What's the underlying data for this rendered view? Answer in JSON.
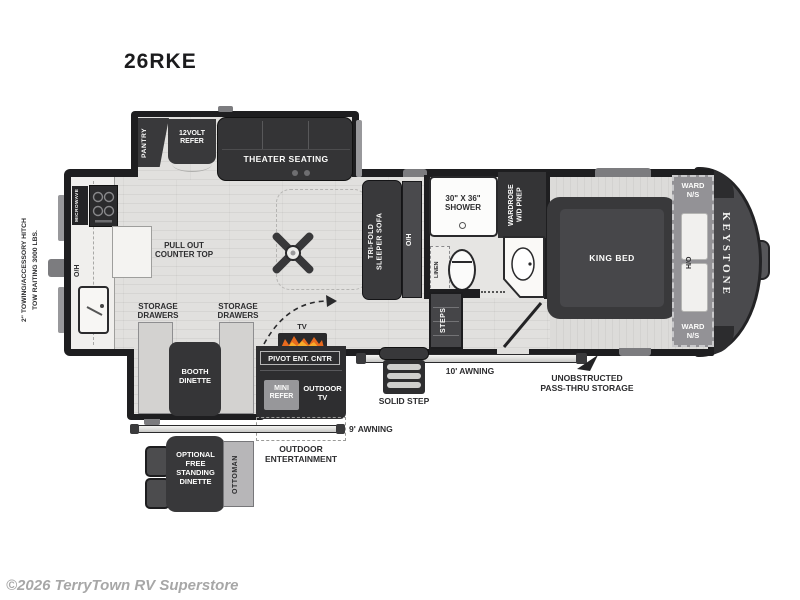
{
  "title": "26RKE",
  "copyright": "©2026 TerryTown RV Superstore",
  "brand": "KEYSTONE",
  "colors": {
    "wall": "#1e1e20",
    "furniture": "#39393b",
    "floor": "#e1e0de",
    "flame": "#e86a1e"
  },
  "exterior": {
    "hitch_note": "2\" TOWING/ACCESSORY HITCH\nTOW RAITING 3000 LBS.",
    "awning_main": "10' AWNING",
    "awning_rear": "9' AWNING",
    "solid_step": "SOLID STEP",
    "pass_thru": "UNOBSTRUCTED\nPASS-THRU STORAGE",
    "outdoor_entertainment": "OUTDOOR\nENTERTAINMENT",
    "outdoor_tv": "OUTDOOR\nTV",
    "mini_refer": "MINI\nREFER"
  },
  "kitchen": {
    "pantry": "PANTRY",
    "refer": "12VOLT\nREFER",
    "microwave": "MICROWAVE",
    "overhead": "O/H",
    "pullout_counter": "PULL OUT\nCOUNTER TOP",
    "storage_drawers_1": "STORAGE\nDRAWERS",
    "storage_drawers_2": "STORAGE\nDRAWERS"
  },
  "living": {
    "theater_seating": "THEATER SEATING",
    "sofa": "TRI-FOLD\nSLEEPER SOFA",
    "sofa_overhead": "O/H",
    "booth_dinette": "BOOTH\nDINETTE",
    "tv": "TV",
    "pivot_ent": "PIVOT ENT. CNTR",
    "steps": "STEPS"
  },
  "bathroom": {
    "shower": "30\" X 36\"\nSHOWER",
    "wardrobe": "WARDROBE\nW/D PREP",
    "linen": "LINEN"
  },
  "bedroom": {
    "king_bed": "KING BED",
    "ward_ns_top": "WARD\nN/S",
    "ward_ns_bottom": "WARD\nN/S",
    "ho": "H/O"
  },
  "optional": {
    "dinette": "OPTIONAL\nFREE\nSTANDING\nDINETTE",
    "ottoman": "OTTOMAN"
  }
}
